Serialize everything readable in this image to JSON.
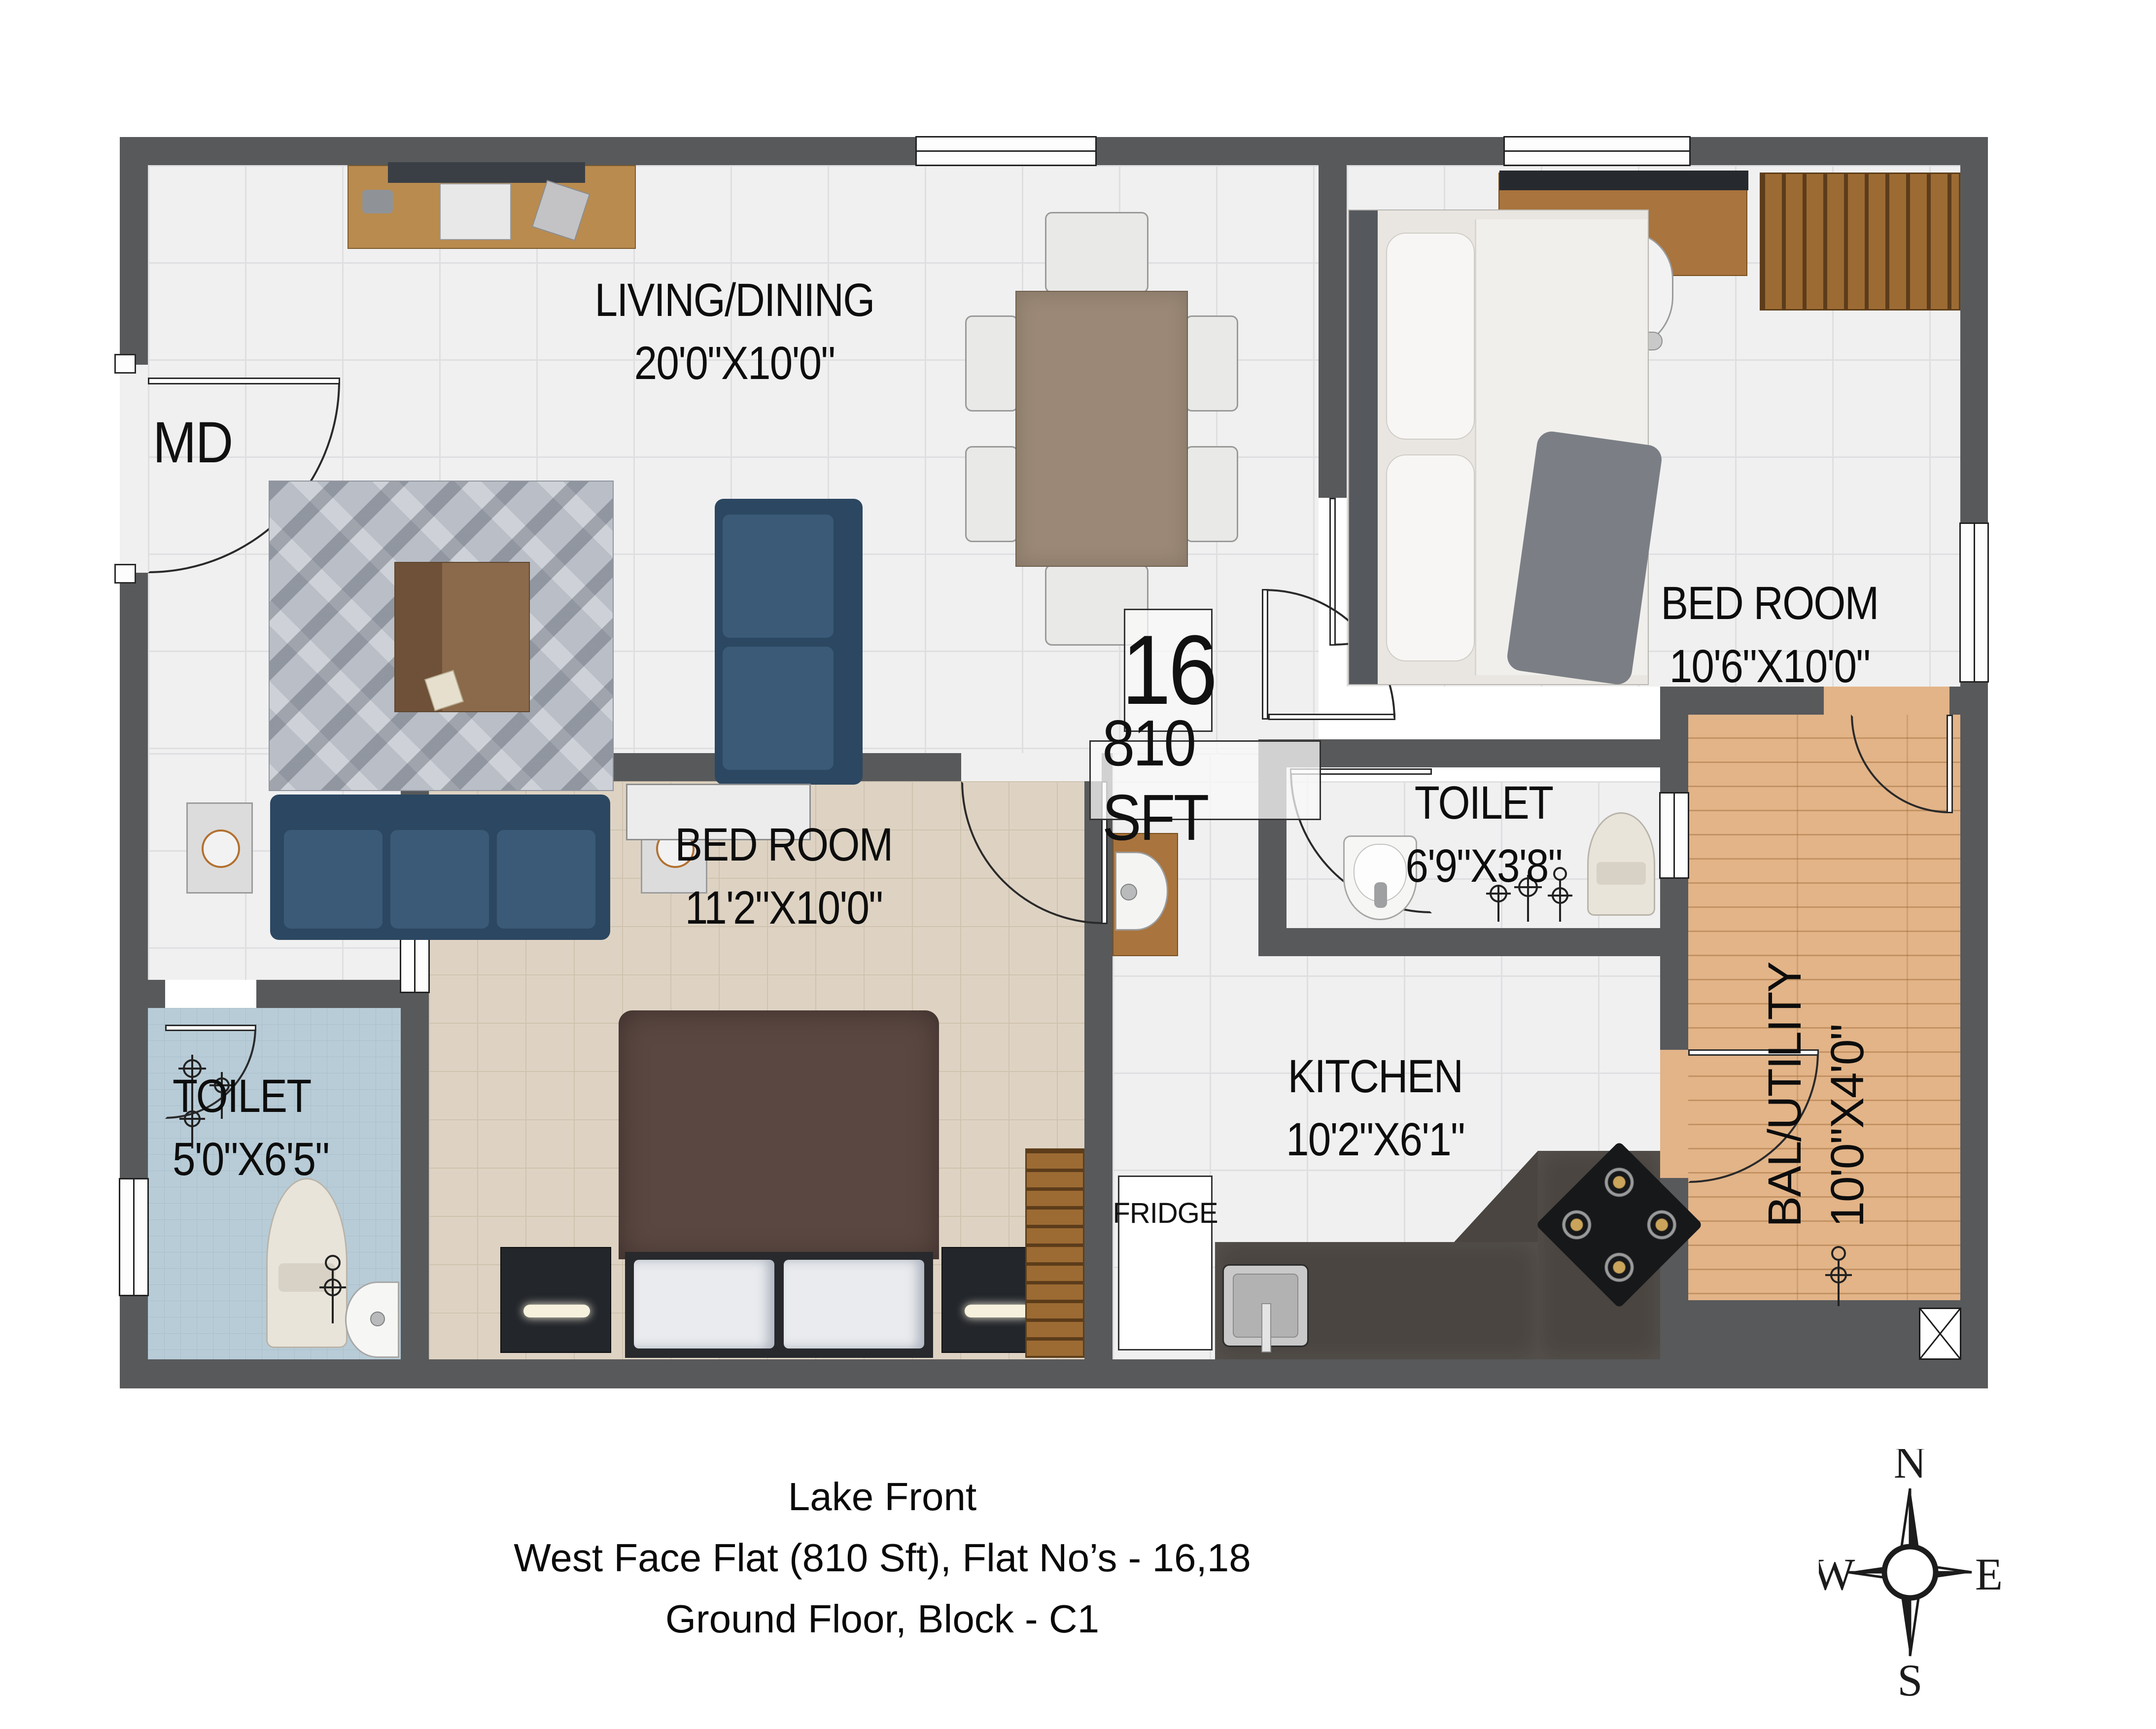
{
  "plan": {
    "unit": {
      "number": "16",
      "area": "810 SFT"
    },
    "rooms": {
      "living": {
        "name": "LIVING/DINING",
        "dims": "20'0\"X10'0\""
      },
      "bedroom_top": {
        "name": "BED ROOM",
        "dims": "10'6\"X10'0\""
      },
      "bedroom_mid": {
        "name": "BED ROOM",
        "dims": "11'2\"X10'0\""
      },
      "toilet_right": {
        "name": "TOILET",
        "dims": "6'9\"X3'8\""
      },
      "toilet_left": {
        "name": "TOILET",
        "dims": "5'0\"X6'5\""
      },
      "kitchen": {
        "name": "KITCHEN",
        "dims": "10'2\"X6'1\""
      },
      "balcony": {
        "name": "BAL/UTILITY",
        "dims": "10'0\"X4'0\""
      }
    },
    "labels": {
      "main_door": "MD",
      "fridge": "FRIDGE"
    }
  },
  "compass": {
    "north": "N",
    "south": "S",
    "east": "E",
    "west": "W"
  },
  "title_lines": [
    "Lake Front",
    "West Face Flat (810 Sft), Flat No’s - 16,18",
    "Ground Floor, Block - C1"
  ],
  "colors": {
    "wall": "#58595b",
    "toilet_floor": "#b8ccd7",
    "bedroom_floor": "#ded3c3",
    "balcony_floor": "#e2b488",
    "sofa": "#2c4761",
    "counter": "#4a4540",
    "wardrobe_wood": "#9c6b33"
  }
}
